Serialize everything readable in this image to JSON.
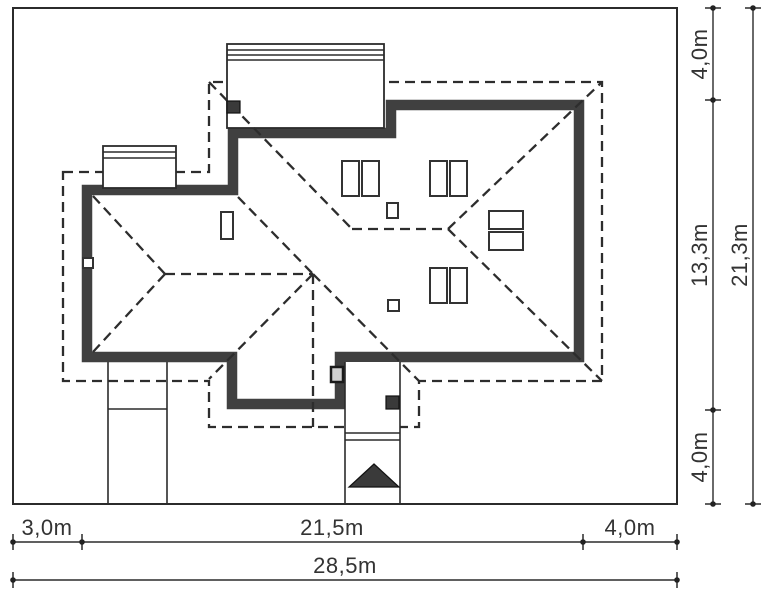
{
  "drawing": {
    "kind": "house plot plan with roof view",
    "colors": {
      "wall": "#404040",
      "line": "#2b2b2b",
      "background": "#ffffff",
      "dark_fill": "#3a3a3a"
    }
  },
  "dimensions": {
    "bottom_row": [
      "3,0m",
      "21,5m",
      "4,0m"
    ],
    "bottom_total": "28,5m",
    "right_col": [
      "4,0m",
      "13,3m",
      "4,0m"
    ],
    "right_total": "21,3m"
  }
}
